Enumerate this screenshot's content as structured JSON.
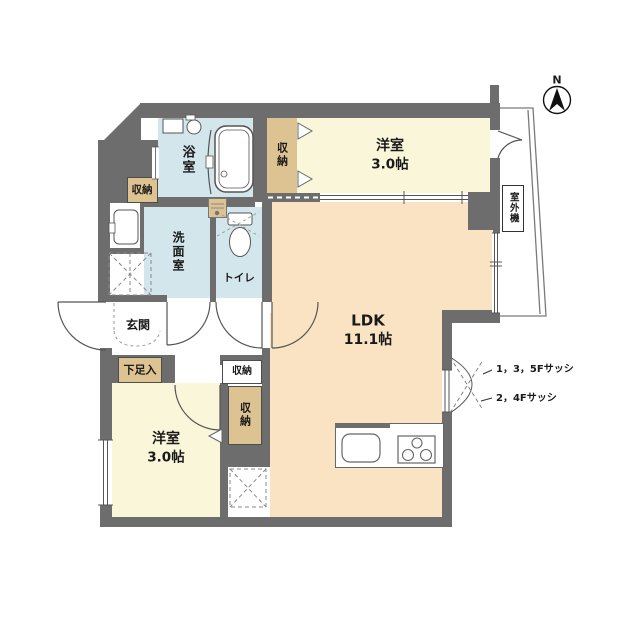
{
  "plan_title": "1LDK+2S floor plan",
  "colors": {
    "wall": "#6d6d6d",
    "wet_room_floor": "#d3e6ec",
    "bedroom_floor": "#faf6da",
    "ldk_floor": "#fae3c2",
    "storage_fill": "#ddc392",
    "line": "#555555"
  },
  "compass": {
    "north_label": "N"
  },
  "rooms": {
    "ldk": {
      "name": "LDK",
      "size": "11.1帖"
    },
    "bedroom_north": {
      "name": "洋室",
      "size": "3.0帖"
    },
    "bedroom_south": {
      "name": "洋室",
      "size": "3.0帖"
    },
    "bath": {
      "name": "浴室"
    },
    "washroom": {
      "name": "洗面室"
    },
    "toilet": {
      "name": "トイレ"
    },
    "entrance": {
      "name": "玄関"
    }
  },
  "storage": {
    "closet_north": {
      "name": "収納"
    },
    "closet_west": {
      "name": "収納"
    },
    "closet_hall": {
      "name": "収納"
    },
    "closet_south": {
      "name": "収納"
    },
    "shoe_cabinet": {
      "name": "下足入"
    }
  },
  "balcony": {
    "outdoor_unit_label": "室外機"
  },
  "annotations": {
    "sash_135f": "1，3，5Fサッシ",
    "sash_24f": "2，4Fサッシ"
  },
  "fixtures": [
    "bathtub",
    "washbasin",
    "toilet",
    "washer",
    "laundry-pan",
    "kitchen-sink",
    "gas-stove",
    "refrigerator-space"
  ]
}
